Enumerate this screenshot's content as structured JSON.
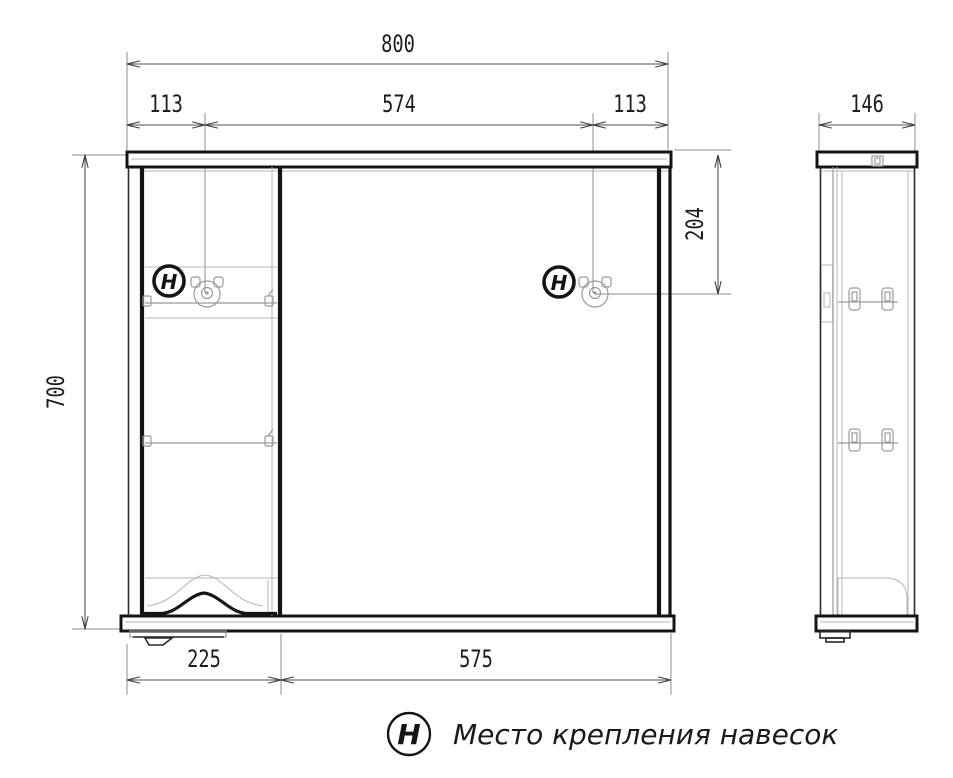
{
  "drawing": {
    "front_view": {
      "dims": {
        "width_total": "800",
        "width_left": "113",
        "width_center": "574",
        "width_right": "113",
        "height_total": "700",
        "hanger_offset": "204",
        "width_shelf_section": "225",
        "width_door_section": "575"
      },
      "hanger_marks": [
        "H",
        "H"
      ]
    },
    "side_view": {
      "dims": {
        "depth": "146"
      }
    },
    "legend": {
      "symbol": "H",
      "label": "Место крепления навесок"
    },
    "colors": {
      "ink": "#141414",
      "light_detail": "#b4b4b4",
      "dimension": "#4f4f4f",
      "background": "#ffffff"
    }
  }
}
